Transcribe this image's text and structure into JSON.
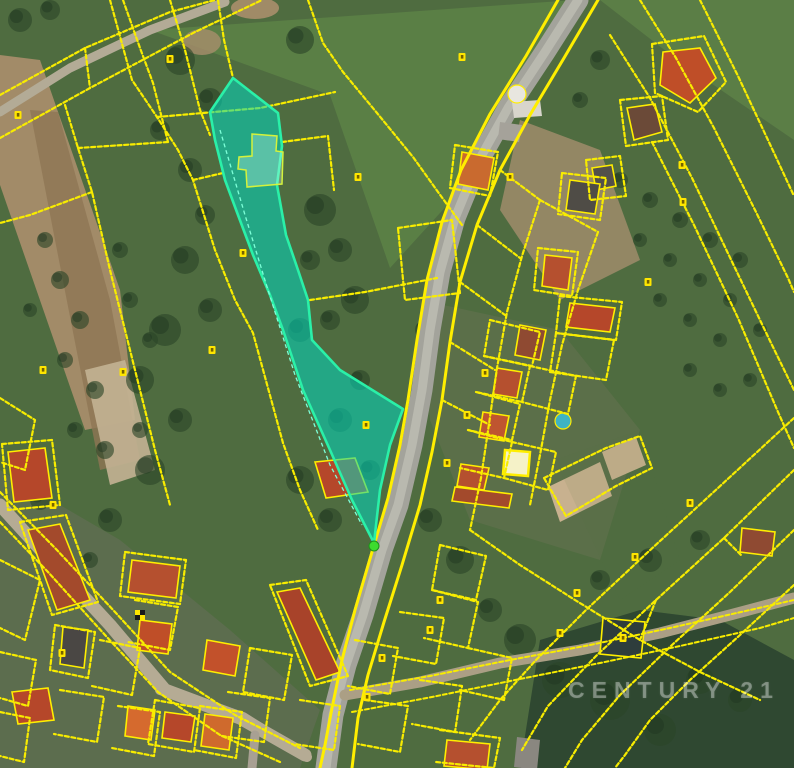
{
  "watermark": {
    "text": "CENTURY 21"
  },
  "palette": {
    "base_green": "#4f6c40",
    "meadow_green": "#5a7f45",
    "woods_dark": "#2f4831",
    "tree_green": "#2b4529",
    "field_brown": "#a28b68",
    "field_brown_dark": "#8f7554",
    "court_tan": "#c8b18f",
    "road_gray": "#a3a39b",
    "road_core": "#b9b9af",
    "path_tan": "#b3ab96",
    "parcel_yellow": "#f8ec00",
    "road_edge_yellow": "#ffee00",
    "highlight_fill": "rgba(0,216,190,0.55)",
    "highlight_stroke": "#2af0a8",
    "inner_parcel_stroke": "#d4f23c",
    "inner_dash": "#7dffd8",
    "marker_yellow": "#ffe600",
    "marker_speck": "#756200",
    "tip_dot_green": "#3ddb2f",
    "pool_blue": "#3fb3c4"
  },
  "map": {
    "width": 794,
    "height": 768,
    "terrain": [
      {
        "kind": "poly",
        "pts": "150,30 575,0 560,40 470,180 390,268 330,95",
        "fill": "#5a7f45",
        "op": 1
      },
      {
        "kind": "poly",
        "pts": "600,0 794,0 794,140 680,62",
        "fill": "#5b7e46",
        "op": 1
      },
      {
        "kind": "poly",
        "pts": "0,55 40,60 120,290 135,420 85,430 0,185",
        "fill": "#a28b68",
        "op": 1
      },
      {
        "kind": "poly",
        "pts": "30,110 58,112 110,300 140,460 100,470 55,240",
        "fill": "#8f7554",
        "op": 0.8
      },
      {
        "kind": "poly",
        "pts": "85,370 125,360 155,470 110,485",
        "fill": "#c3b294",
        "op": 0.9
      },
      {
        "kind": "ellipse",
        "cx": 255,
        "cy": 8,
        "rx": 24,
        "ry": 11,
        "fill": "#a88f6b",
        "op": 0.9
      },
      {
        "kind": "ellipse",
        "cx": 202,
        "cy": 42,
        "rx": 19,
        "ry": 13,
        "fill": "#a88f6b",
        "op": 0.8
      },
      {
        "kind": "poly",
        "pts": "520,120 600,150 640,260 560,300 500,210",
        "fill": "#a99070",
        "op": 0.75
      },
      {
        "kind": "poly",
        "pts": "0,470 120,540 230,630 320,710 300,768 0,768",
        "fill": "#68705a",
        "op": 0.55
      },
      {
        "kind": "poly",
        "pts": "420,300 560,330 640,430 600,560 470,520 430,420",
        "fill": "#6d7558",
        "op": 0.4
      },
      {
        "kind": "poly",
        "pts": "520,768 540,640 640,610 720,620 794,660 794,768",
        "fill": "#2f4831",
        "op": 1
      },
      {
        "kind": "poly",
        "pts": "548,487 600,462 612,496 560,522",
        "fill": "#c8b18f",
        "op": 1
      },
      {
        "kind": "poly",
        "pts": "602,452 636,437 646,465 612,480",
        "fill": "#c8b18f",
        "op": 1
      },
      {
        "kind": "poly",
        "pts": "555,460 620,600 680,560 640,430",
        "fill": "#55744150",
        "op": 0.3
      }
    ],
    "trees": [
      [
        180,
        60,
        15
      ],
      [
        210,
        100,
        12
      ],
      [
        160,
        130,
        10
      ],
      [
        300,
        40,
        14
      ],
      [
        20,
        20,
        12
      ],
      [
        50,
        10,
        10
      ],
      [
        190,
        170,
        12
      ],
      [
        205,
        215,
        10
      ],
      [
        185,
        260,
        14
      ],
      [
        210,
        310,
        12
      ],
      [
        165,
        330,
        16
      ],
      [
        140,
        380,
        14
      ],
      [
        180,
        420,
        12
      ],
      [
        150,
        470,
        15
      ],
      [
        110,
        520,
        12
      ],
      [
        320,
        210,
        16
      ],
      [
        340,
        250,
        12
      ],
      [
        310,
        260,
        10
      ],
      [
        355,
        300,
        14
      ],
      [
        330,
        320,
        10
      ],
      [
        300,
        330,
        12
      ],
      [
        425,
        330,
        10
      ],
      [
        300,
        480,
        14
      ],
      [
        330,
        520,
        12
      ],
      [
        370,
        470,
        10
      ],
      [
        430,
        520,
        12
      ],
      [
        460,
        560,
        14
      ],
      [
        490,
        610,
        12
      ],
      [
        520,
        640,
        16
      ],
      [
        560,
        680,
        18
      ],
      [
        610,
        700,
        20
      ],
      [
        660,
        730,
        16
      ],
      [
        700,
        680,
        14
      ],
      [
        740,
        700,
        12
      ],
      [
        600,
        580,
        10
      ],
      [
        650,
        560,
        12
      ],
      [
        700,
        540,
        10
      ],
      [
        620,
        180,
        8
      ],
      [
        650,
        200,
        8
      ],
      [
        680,
        220,
        8
      ],
      [
        710,
        240,
        8
      ],
      [
        740,
        260,
        8
      ],
      [
        640,
        240,
        7
      ],
      [
        670,
        260,
        7
      ],
      [
        700,
        280,
        7
      ],
      [
        730,
        300,
        7
      ],
      [
        660,
        300,
        7
      ],
      [
        690,
        320,
        7
      ],
      [
        720,
        340,
        7
      ],
      [
        760,
        330,
        7
      ],
      [
        750,
        380,
        7
      ],
      [
        720,
        390,
        7
      ],
      [
        690,
        370,
        7
      ],
      [
        60,
        280,
        9
      ],
      [
        80,
        320,
        9
      ],
      [
        65,
        360,
        8
      ],
      [
        95,
        390,
        9
      ],
      [
        75,
        430,
        8
      ],
      [
        105,
        450,
        9
      ],
      [
        130,
        300,
        8
      ],
      [
        150,
        340,
        8
      ],
      [
        120,
        250,
        8
      ],
      [
        45,
        240,
        8
      ],
      [
        30,
        310,
        7
      ],
      [
        140,
        430,
        8
      ],
      [
        600,
        60,
        10
      ],
      [
        580,
        100,
        8
      ],
      [
        40,
        500,
        10
      ],
      [
        90,
        560,
        8
      ],
      [
        340,
        420,
        12
      ],
      [
        360,
        380,
        10
      ]
    ],
    "roads": [
      {
        "pts": "578,0 545,52 508,108 478,162 455,218 440,272 430,330 422,390 412,445 398,505 382,550 363,615 346,665 333,715 326,768",
        "w": 21,
        "color": "#a3a39b"
      },
      {
        "pts": "578,0 545,52 508,108 478,162 455,218 440,272 430,330 422,390 412,445 398,505 382,550 363,615 346,665 333,715 326,768",
        "w": 9,
        "color": "#b9b9af"
      },
      {
        "pts": "0,505 50,560 110,625 165,690 240,718 305,755",
        "w": 13,
        "color": "#b5ab94"
      },
      {
        "pts": "160,690 243,717 307,757",
        "w": 10,
        "color": "#b5ab94"
      },
      {
        "pts": "345,695 420,682 500,663 580,650 660,633 730,615 794,598",
        "w": 11,
        "color": "#ab9f85"
      },
      {
        "pts": "0,112 70,68 150,30 225,2",
        "w": 9,
        "color": "#b3ab96"
      },
      {
        "pts": "255,735 252,768",
        "w": 9,
        "color": "#a8a093"
      }
    ],
    "buildings": [
      {
        "pts": "663,52 700,48 716,78 690,103 660,85",
        "fill": "#bf4e28"
      },
      {
        "pts": "627,108 655,104 662,132 634,140",
        "fill": "#6b4a38"
      },
      {
        "pts": "592,168 612,165 616,186 596,190",
        "fill": "#53504a"
      },
      {
        "pts": "545,255 572,258 568,290 542,286",
        "fill": "#b5502f"
      },
      {
        "pts": "462,152 494,158 488,190 458,184",
        "fill": "#c96a2f"
      },
      {
        "pts": "512,102 540,100 542,116 514,118",
        "fill": "#d8d5cc",
        "stroke": false
      },
      {
        "pts": "500,122 522,125 519,142 498,139",
        "fill": "#a5a29a",
        "stroke": false
      },
      {
        "pts": "570,303 615,308 610,332 566,327",
        "fill": "#b5472a"
      },
      {
        "pts": "520,325 546,330 540,360 515,355",
        "fill": "#8f4a32"
      },
      {
        "pts": "497,368 522,372 517,398 493,394",
        "fill": "#b5502f"
      },
      {
        "pts": "483,412 509,416 504,441 479,437",
        "fill": "#bf5530"
      },
      {
        "pts": "505,450 530,452 528,476 503,474",
        "fill": "#f5f2c8",
        "w": 2.5
      },
      {
        "pts": "461,464 489,468 484,490 457,486",
        "fill": "#b5502f"
      },
      {
        "pts": "455,487 512,494 509,508 452,501",
        "fill": "#a34a2c"
      },
      {
        "pts": "603,618 645,622 641,658 600,654",
        "fill": "#2e3d3c"
      },
      {
        "pts": "742,528 775,532 772,556 740,552",
        "fill": "#8f4a32"
      },
      {
        "pts": "8,452 45,448 52,498 14,502",
        "fill": "#b5472a"
      },
      {
        "pts": "28,530 60,524 90,600 57,610",
        "fill": "#a34a2c"
      },
      {
        "pts": "63,627 88,630 84,668 60,664",
        "fill": "#4a4744"
      },
      {
        "pts": "132,560 180,566 176,598 128,592",
        "fill": "#b5502f"
      },
      {
        "pts": "140,620 172,624 168,654 137,650",
        "fill": "#bf4e28"
      },
      {
        "pts": "277,592 300,588 340,672 316,680",
        "fill": "#a8432a"
      },
      {
        "pts": "207,640 240,646 235,676 203,670",
        "fill": "#c2512b"
      },
      {
        "pts": "165,712 195,716 191,742 162,738",
        "fill": "#b5472a"
      },
      {
        "pts": "205,714 233,718 229,750 201,746",
        "fill": "#cf6a2d"
      },
      {
        "pts": "128,706 155,710 151,740 125,736",
        "fill": "#d56a2e"
      },
      {
        "pts": "12,692 48,688 54,720 18,724",
        "fill": "#b5472a"
      },
      {
        "pts": "447,740 490,744 487,770 444,766",
        "fill": "#b5502f"
      },
      {
        "pts": "517,737 540,740 537,770 514,767",
        "fill": "#8a8780",
        "stroke": false
      },
      {
        "pts": "570,180 600,184 595,214 566,210",
        "fill": "#4f4c46"
      },
      {
        "pts": "315,462 355,458 368,492 326,498",
        "fill": "#b5472a"
      }
    ],
    "circles": [
      {
        "cx": 517,
        "cy": 94,
        "r": 9,
        "fill": "#e8e6df"
      },
      {
        "cx": 563,
        "cy": 421,
        "r": 8,
        "fill": "#3fb3c4"
      }
    ],
    "parcel_lines": [
      {
        "pts": "0,95 85,48 170,12 215,0"
      },
      {
        "pts": "0,138 90,88 195,32 262,0"
      },
      {
        "pts": "85,48 90,88"
      },
      {
        "pts": "110,0 132,80 157,117 178,150 193,180 215,250 235,300 253,333 283,443 300,490 318,530"
      },
      {
        "pts": "193,180 223,173"
      },
      {
        "pts": "65,105 78,148 92,192 110,270 125,330 140,390 155,450 170,505"
      },
      {
        "pts": "92,192 30,215 0,223"
      },
      {
        "pts": "78,148 168,142"
      },
      {
        "pts": "123,0 140,48 153,83 168,142"
      },
      {
        "pts": "170,0 185,50 200,110 210,135"
      },
      {
        "pts": "218,0 224,40 233,78"
      },
      {
        "pts": "308,0 323,43 343,72 377,113 413,157 438,192 462,225"
      },
      {
        "pts": "157,117 260,108 335,92"
      },
      {
        "pts": "282,142 328,136 334,190"
      },
      {
        "pts": "398,228 452,220 460,293 405,300 398,228"
      },
      {
        "pts": "310,300 365,292 437,278"
      },
      {
        "pts": "558,0 526,56 490,114 461,170 442,222 427,280 417,340 408,400 400,445 388,498 372,552 355,610 342,660 332,708 325,745 320,768",
        "w": 3,
        "solid": true
      },
      {
        "pts": "598,0 564,58 530,115 500,170 477,225 460,282 450,342 442,400 432,452 420,505 402,565 384,622 368,675 358,718 352,768",
        "w": 3,
        "solid": true
      },
      {
        "pts": "640,0 676,58 714,128 756,212 788,278 794,292"
      },
      {
        "pts": "700,0 738,76 775,155 794,196"
      },
      {
        "pts": "610,35 650,98 692,178 735,268 772,345 794,390"
      },
      {
        "pts": "652,142 694,225 738,318 778,412 794,448"
      },
      {
        "pts": "652,44 704,36 726,82 698,112 655,93 652,44"
      },
      {
        "pts": "620,100 662,96 668,140 626,146 620,100"
      },
      {
        "pts": "586,160 620,156 626,196 590,200 586,160"
      },
      {
        "pts": "455,145 498,152 490,196 450,188 455,145"
      },
      {
        "pts": "538,248 578,252 572,296 534,290 538,248"
      },
      {
        "pts": "562,173 606,178 600,220 558,214 562,173"
      },
      {
        "pts": "500,170 540,200"
      },
      {
        "pts": "477,225 520,258"
      },
      {
        "pts": "460,282 505,315"
      },
      {
        "pts": "450,342 495,370"
      },
      {
        "pts": "442,400 490,425"
      },
      {
        "pts": "540,200 522,256 507,312 497,368 489,424 481,478 470,530"
      },
      {
        "pts": "598,232 578,290 562,345 550,400 540,455 530,505"
      },
      {
        "pts": "540,200 598,232"
      },
      {
        "pts": "470,530 520,565 575,600 640,640 700,672 760,700"
      },
      {
        "pts": "794,470 724,538 656,600 596,656 548,706 522,750"
      },
      {
        "pts": "794,418 718,488 648,552 586,610 536,660 500,700 470,740"
      },
      {
        "pts": "794,530 730,592 672,645 620,695 582,740 565,768"
      },
      {
        "pts": "794,585 740,635 690,680 650,720 625,755 615,768"
      },
      {
        "pts": "656,600 640,640"
      },
      {
        "pts": "724,538 742,556"
      },
      {
        "pts": "544,478 606,448 640,436 652,468 616,486 566,516 544,478"
      },
      {
        "pts": "560,296 622,302 616,340 556,333 560,296"
      },
      {
        "pts": "556,333 614,340 606,380 550,372 556,333"
      },
      {
        "pts": "490,320 540,332 532,366 484,356 490,320"
      },
      {
        "pts": "484,356 530,366 522,402 476,392"
      },
      {
        "pts": "476,392 520,404 512,440 468,430"
      },
      {
        "pts": "468,430 512,442 504,478 460,468"
      },
      {
        "pts": "512,442 556,452 548,490 504,478"
      },
      {
        "pts": "530,366 576,376 568,414 522,402"
      },
      {
        "pts": "0,492 55,548 115,612 170,672 235,715 300,748"
      },
      {
        "pts": "0,522 48,572 105,635 158,692 220,735 280,762"
      },
      {
        "pts": "2,444 52,440 60,505 8,510 2,444"
      },
      {
        "pts": "20,522 66,515 98,602 52,615 20,522"
      },
      {
        "pts": "125,552 186,560 180,604 120,596 125,552"
      },
      {
        "pts": "270,585 306,580 348,676 310,686 270,585"
      },
      {
        "pts": "0,560 40,580 25,640 0,628"
      },
      {
        "pts": "55,625 95,632 88,678 50,670 55,625"
      },
      {
        "pts": "100,640 140,648 132,695 92,686"
      },
      {
        "pts": "135,600 178,607 170,650 128,642"
      },
      {
        "pts": "155,700 200,708 194,752 148,744 155,700"
      },
      {
        "pts": "200,706 242,712 236,758 194,750"
      },
      {
        "pts": "228,692 270,698 264,742 222,736"
      },
      {
        "pts": "118,706 160,712 154,756 112,748"
      },
      {
        "pts": "60,690 104,697 97,742 54,734"
      },
      {
        "pts": "0,652 36,660 28,706 0,698"
      },
      {
        "pts": "0,712 30,718 24,762 0,756"
      },
      {
        "pts": "250,648 292,655 284,700 243,692 250,648"
      },
      {
        "pts": "300,700 340,706 334,750 294,744"
      },
      {
        "pts": "355,640 398,648 390,694 348,686"
      },
      {
        "pts": "365,700 408,706 400,752 358,744"
      },
      {
        "pts": "400,612 444,618 436,664 393,656"
      },
      {
        "pts": "420,680 462,686 455,732 412,724"
      },
      {
        "pts": "440,730 500,738 494,768 436,762"
      },
      {
        "pts": "440,545 486,556 476,600 432,590 440,545"
      },
      {
        "pts": "432,590 478,602 468,648 424,638"
      },
      {
        "pts": "468,648 512,658 504,700 460,690"
      },
      {
        "pts": "350,690 430,676 510,660 590,645 670,628 750,610 794,600",
        "w": 2
      },
      {
        "pts": "352,712 432,697 515,680 600,663 680,646 760,628 794,618",
        "w": 2
      },
      {
        "pts": "0,398 35,420 25,470 0,462"
      }
    ],
    "highlight": {
      "outer": "233,78 278,113 282,146 277,185 286,235 298,270 308,300 312,340 340,370 403,409 390,445 380,490 374,543 352,500 330,450 303,390 283,330 270,295 253,255 238,215 225,180 215,140 210,112",
      "inner": "252,134 277,136 276,151 283,152 282,184 247,187 246,170 238,169 239,157 252,156",
      "inner_line": "220,130 245,215 268,290 295,375 330,465 362,525"
    },
    "markers": [
      [
        358,
        177
      ],
      [
        510,
        177
      ],
      [
        170,
        59
      ],
      [
        18,
        115
      ],
      [
        243,
        253
      ],
      [
        43,
        370
      ],
      [
        123,
        372
      ],
      [
        212,
        350
      ],
      [
        635,
        557
      ],
      [
        577,
        593
      ],
      [
        560,
        633
      ],
      [
        623,
        638
      ],
      [
        462,
        57
      ],
      [
        682,
        165
      ],
      [
        683,
        202
      ],
      [
        648,
        282
      ],
      [
        485,
        373
      ],
      [
        467,
        415
      ],
      [
        447,
        463
      ],
      [
        440,
        600
      ],
      [
        430,
        630
      ],
      [
        382,
        658
      ],
      [
        367,
        697
      ],
      [
        53,
        505
      ],
      [
        62,
        653
      ],
      [
        690,
        503
      ],
      [
        366,
        425
      ]
    ],
    "checker_marker": {
      "x": 140,
      "y": 615
    },
    "tip_dot": {
      "x": 374,
      "y": 546
    }
  }
}
